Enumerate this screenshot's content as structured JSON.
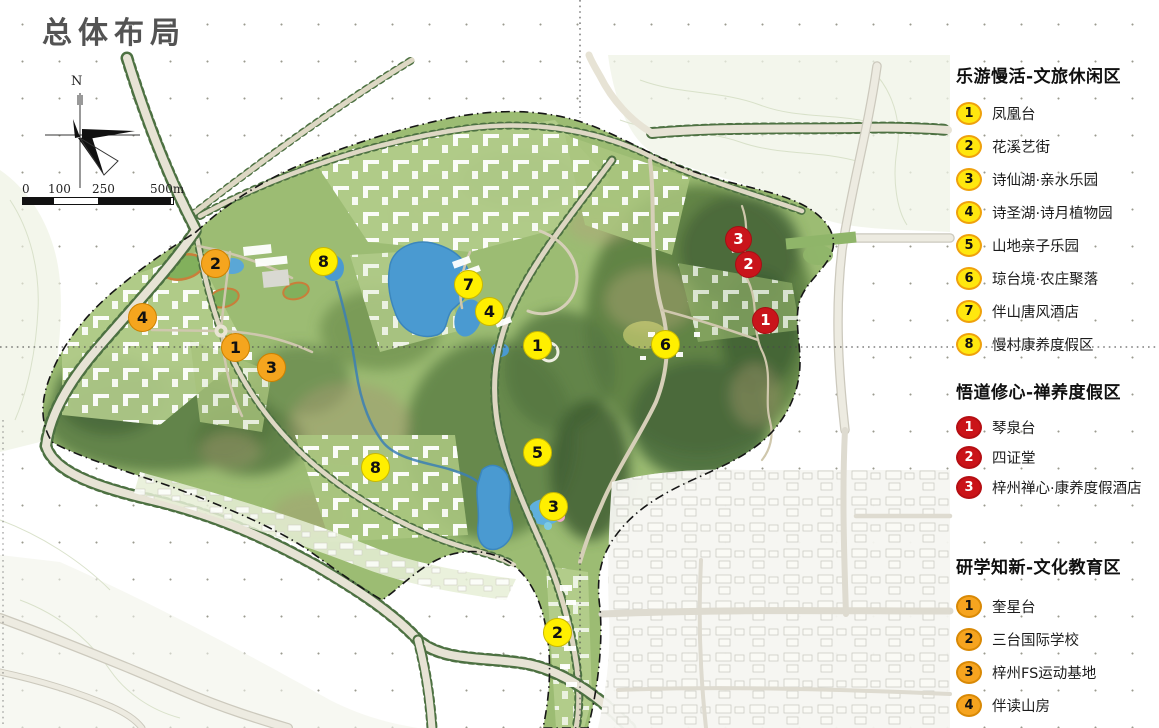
{
  "title": "总体布局",
  "compass": {
    "north_label": "N"
  },
  "scale_bar": {
    "labels": [
      "0",
      "100",
      "250",
      "500m"
    ]
  },
  "legend": {
    "sections": [
      {
        "id": "zone1",
        "title": "乐游慢活-文旅休闲区",
        "marker_style": "yellow",
        "items": [
          {
            "num": "1",
            "label": "凤凰台"
          },
          {
            "num": "2",
            "label": "花溪艺街"
          },
          {
            "num": "3",
            "label": "诗仙湖·亲水乐园"
          },
          {
            "num": "4",
            "label": "诗圣湖·诗月植物园"
          },
          {
            "num": "5",
            "label": "山地亲子乐园"
          },
          {
            "num": "6",
            "label": "琼台境·农庄聚落"
          },
          {
            "num": "7",
            "label": "伴山唐风酒店"
          },
          {
            "num": "8",
            "label": "慢村康养度假区"
          }
        ]
      },
      {
        "id": "zone2",
        "title": "悟道修心-禅养度假区",
        "marker_style": "red",
        "items": [
          {
            "num": "1",
            "label": "琴泉台"
          },
          {
            "num": "2",
            "label": "四证堂"
          },
          {
            "num": "3",
            "label": "梓州禅心·康养度假酒店"
          }
        ]
      },
      {
        "id": "zone3",
        "title": "研学知新-文化教育区",
        "marker_style": "orange",
        "items": [
          {
            "num": "1",
            "label": "奎星台"
          },
          {
            "num": "2",
            "label": "三台国际学校"
          },
          {
            "num": "3",
            "label": "梓州FS运动基地"
          },
          {
            "num": "4",
            "label": "伴读山房"
          }
        ]
      }
    ]
  },
  "map": {
    "colors": {
      "site_green": "#9cbc73",
      "forest_dark": "#46663a",
      "lake_blue": "#4a9ad1",
      "road_pale": "#ebe9df",
      "tree_line": "#4d7142",
      "marker_yellow": "#ffef00",
      "marker_orange": "#f5a51e",
      "marker_red": "#c9141b"
    },
    "markers": [
      {
        "zone": "yellow",
        "num": "8",
        "x": 323,
        "y": 261
      },
      {
        "zone": "yellow",
        "num": "7",
        "x": 468,
        "y": 284
      },
      {
        "zone": "yellow",
        "num": "4",
        "x": 489,
        "y": 311
      },
      {
        "zone": "yellow",
        "num": "1",
        "x": 537,
        "y": 345
      },
      {
        "zone": "yellow",
        "num": "6",
        "x": 665,
        "y": 344
      },
      {
        "zone": "yellow",
        "num": "5",
        "x": 537,
        "y": 452
      },
      {
        "zone": "yellow",
        "num": "8",
        "x": 375,
        "y": 467
      },
      {
        "zone": "yellow",
        "num": "3",
        "x": 553,
        "y": 506
      },
      {
        "zone": "yellow",
        "num": "2",
        "x": 557,
        "y": 632
      },
      {
        "zone": "orange",
        "num": "2",
        "x": 215,
        "y": 263
      },
      {
        "zone": "orange",
        "num": "4",
        "x": 142,
        "y": 317
      },
      {
        "zone": "orange",
        "num": "1",
        "x": 235,
        "y": 347
      },
      {
        "zone": "orange",
        "num": "3",
        "x": 271,
        "y": 367
      },
      {
        "zone": "red",
        "num": "3",
        "x": 738,
        "y": 239
      },
      {
        "zone": "red",
        "num": "2",
        "x": 748,
        "y": 264
      },
      {
        "zone": "red",
        "num": "1",
        "x": 765,
        "y": 320
      }
    ]
  }
}
